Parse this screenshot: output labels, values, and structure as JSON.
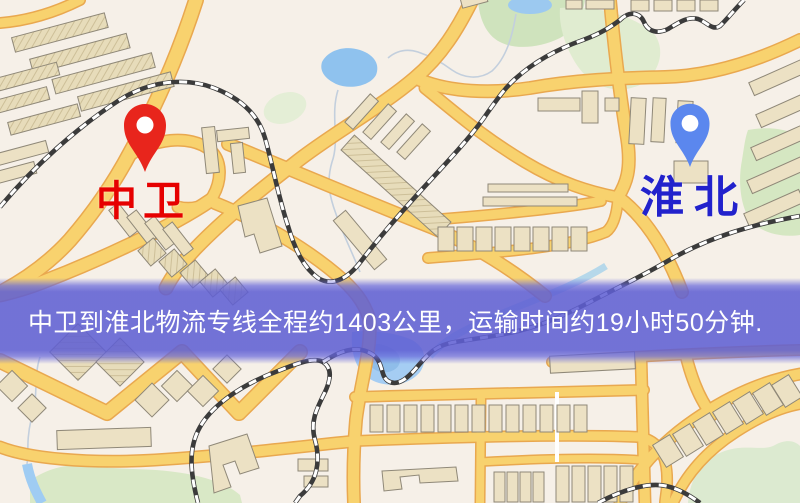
{
  "map": {
    "origin": {
      "name": "中卫",
      "pin_color": "#e8251c",
      "label_color": "#e60000"
    },
    "destination": {
      "name": "淮北",
      "pin_color": "#5b87ee",
      "label_color": "#2222cc"
    }
  },
  "banner": {
    "text": "中卫到淮北物流专线全程约1403公里，运输时间约19小时50分钟.",
    "background": "#5f5fd3",
    "text_color": "#ffffff"
  },
  "route": {
    "origin": "中卫",
    "destination": "淮北",
    "service": "物流专线",
    "distance": "约1403公里",
    "duration": "约19小时50分钟"
  }
}
